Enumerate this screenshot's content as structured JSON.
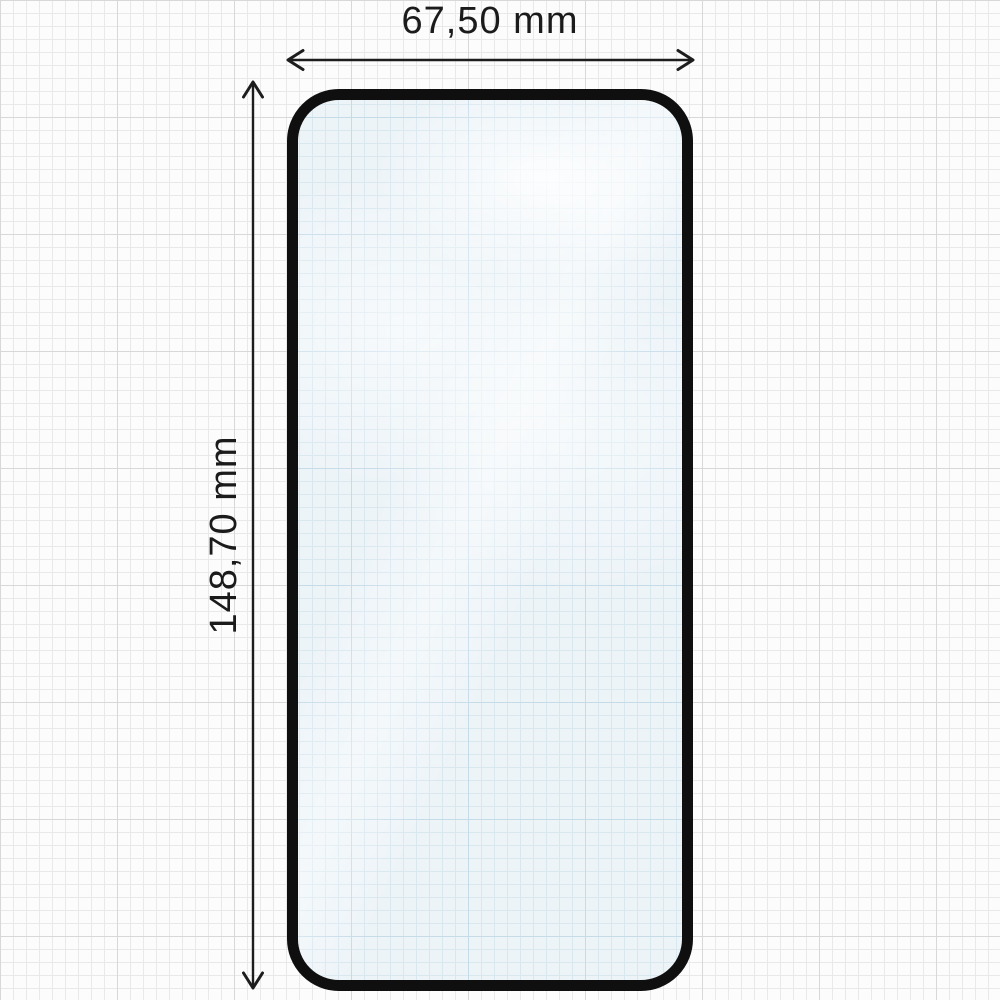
{
  "diagram": {
    "horizontal_dimension": {
      "label": "67,50 mm"
    },
    "vertical_dimension": {
      "label": "148,70 mm"
    }
  },
  "colors": {
    "paper": "#fcfcfc",
    "grid_minor": "#e9e9e9",
    "grid_major": "#d8d8d8",
    "glass_fill": "#edf4f8",
    "glass_grid_minor": "#d9e7ef",
    "glass_grid_major": "#c6dbe8",
    "glass_border": "#0f0f0f",
    "dimension": "#1d1d1d",
    "text": "#1b1b1b"
  }
}
